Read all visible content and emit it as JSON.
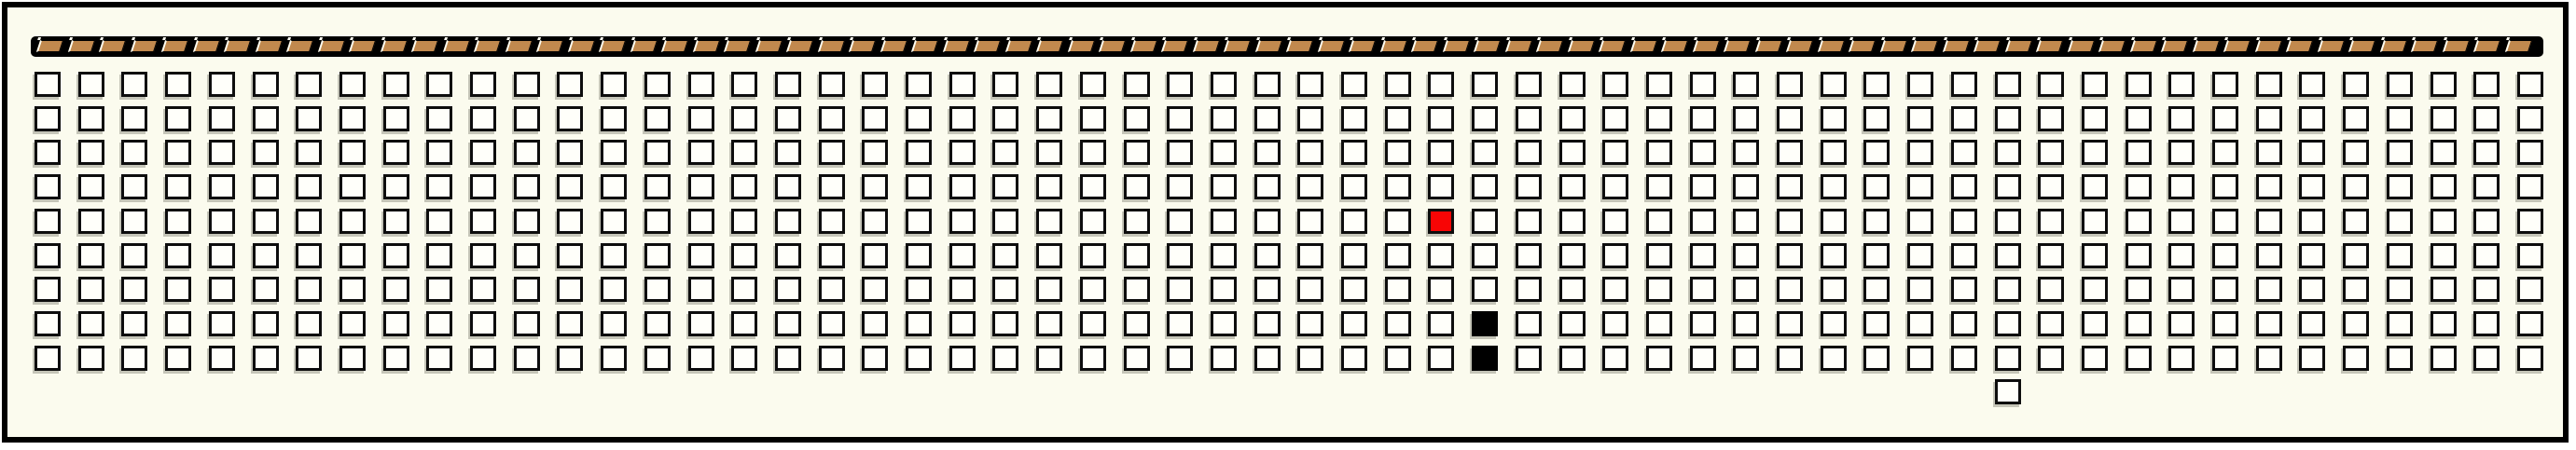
{
  "board": {
    "rows": 9,
    "cols": 58,
    "strip_segments": 80,
    "special_cells": [
      {
        "row": 5,
        "col": 33,
        "color": "red"
      },
      {
        "row": 8,
        "col": 34,
        "color": "black"
      },
      {
        "row": 9,
        "col": 34,
        "color": "black"
      }
    ],
    "extra_cells": [
      {
        "row": 10,
        "col": 46,
        "color": "white"
      }
    ],
    "colors": {
      "panel_background": "#fbfbee",
      "frame_border": "#000000",
      "cell_fill": "#fffffa",
      "cell_border": "#0d0d0d",
      "red_cell": "#f80505",
      "black_cell": "#000000",
      "strip_bar": "#000000",
      "strip_tan": "#c1894e",
      "strip_separator": "#fffef2"
    }
  }
}
